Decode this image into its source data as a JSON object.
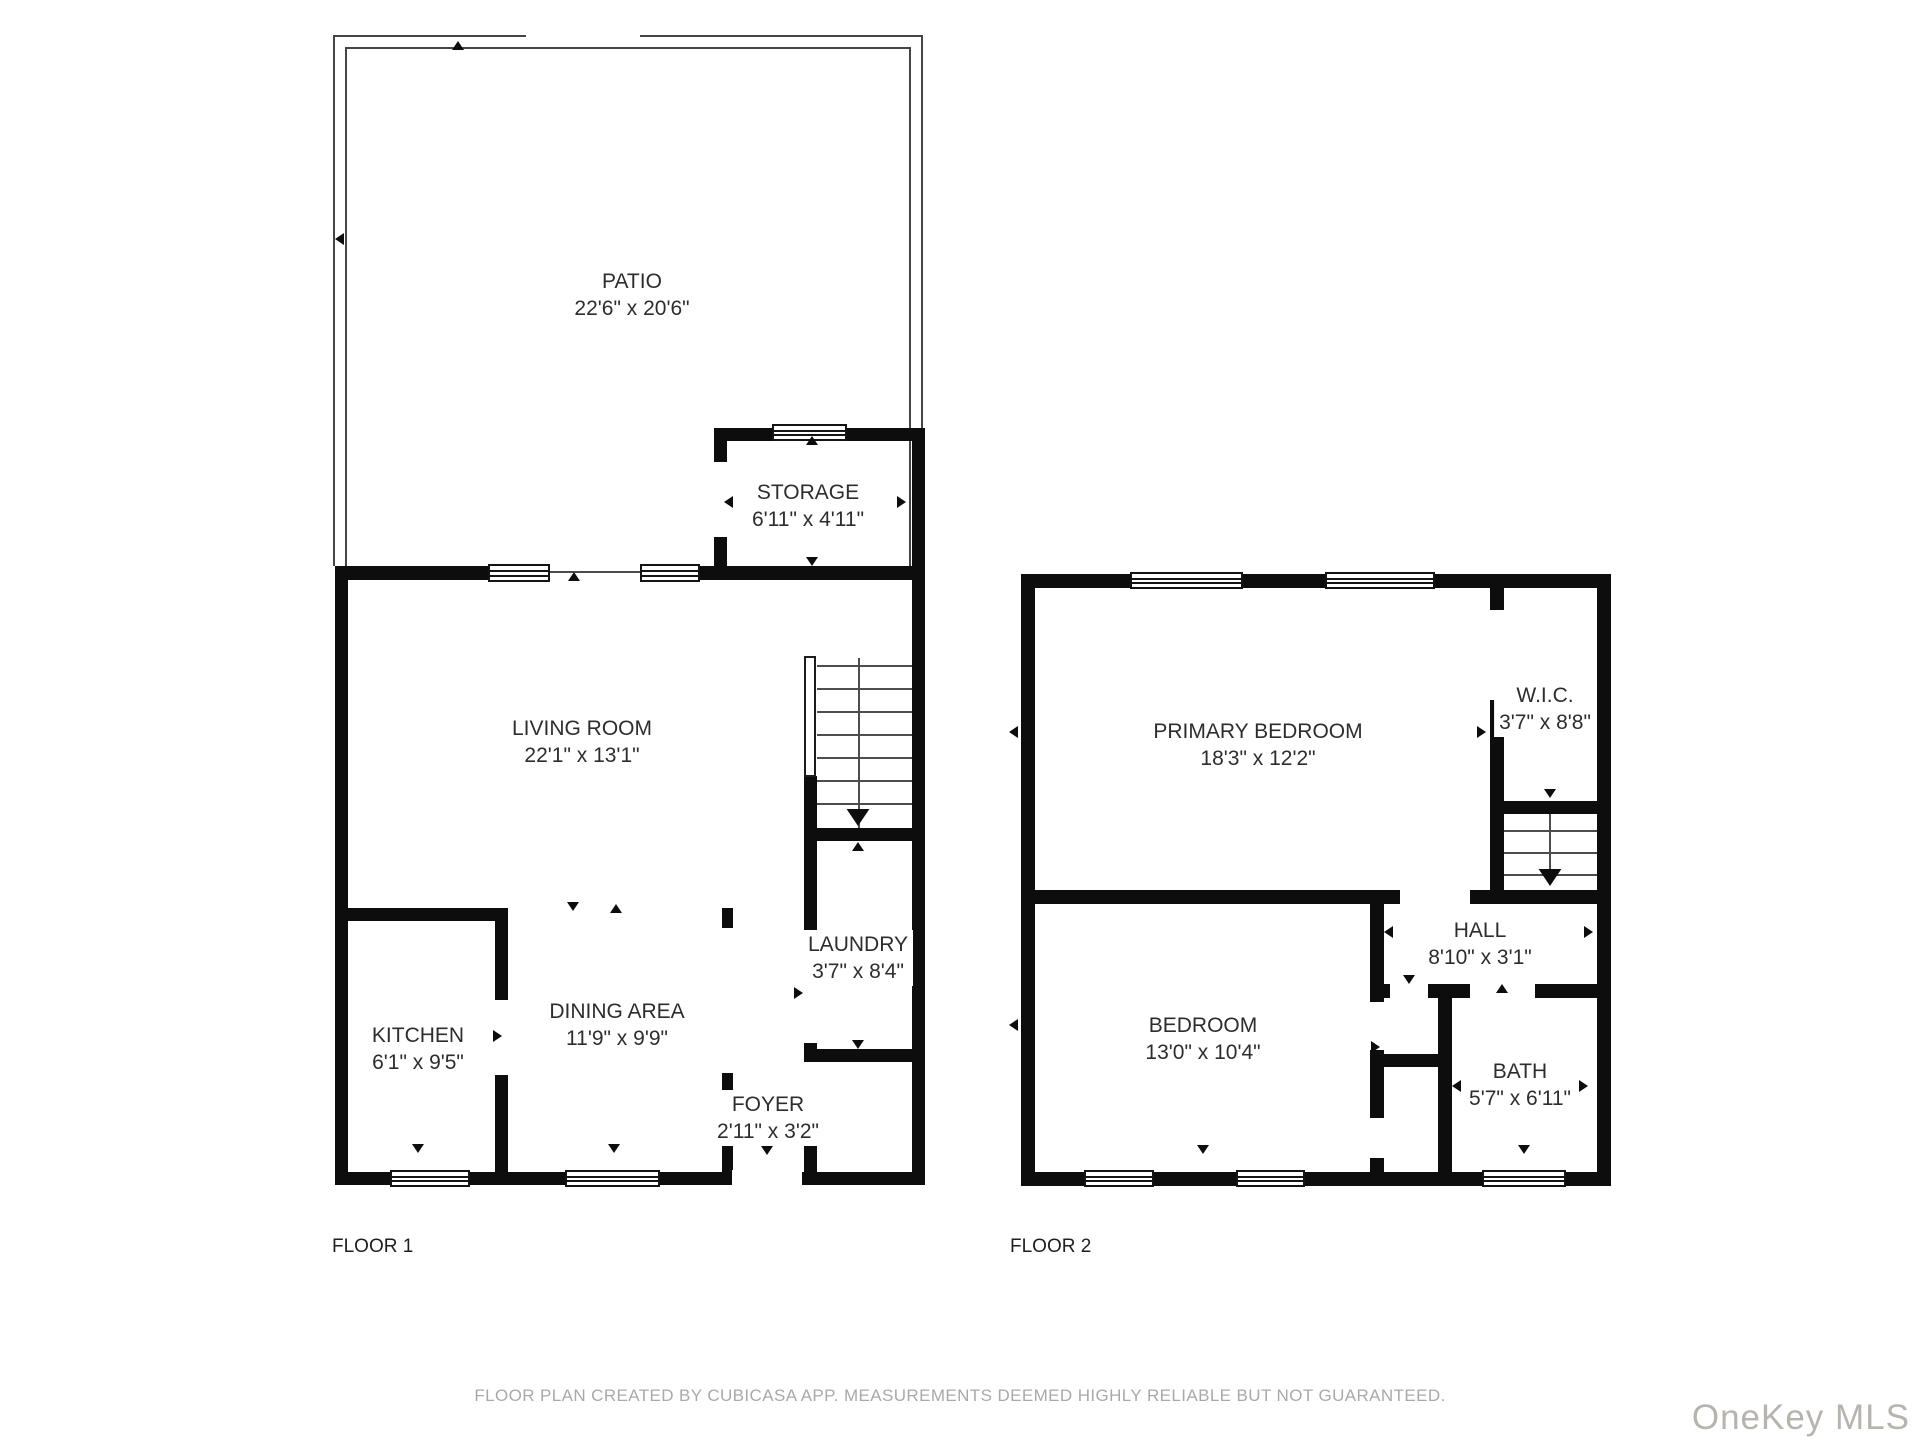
{
  "floor1": {
    "label": "FLOOR 1",
    "rooms": {
      "patio": {
        "name": "PATIO",
        "dims": "22'6\" x 20'6\""
      },
      "storage": {
        "name": "STORAGE",
        "dims": "6'11\" x 4'11\""
      },
      "living_room": {
        "name": "LIVING ROOM",
        "dims": "22'1\" x 13'1\""
      },
      "kitchen": {
        "name": "KITCHEN",
        "dims": "6'1\" x 9'5\""
      },
      "dining_area": {
        "name": "DINING AREA",
        "dims": "11'9\" x 9'9\""
      },
      "laundry": {
        "name": "LAUNDRY",
        "dims": "3'7\" x 8'4\""
      },
      "foyer": {
        "name": "FOYER",
        "dims": "2'11\" x 3'2\""
      }
    }
  },
  "floor2": {
    "label": "FLOOR 2",
    "rooms": {
      "primary_bedroom": {
        "name": "PRIMARY BEDROOM",
        "dims": "18'3\" x 12'2\""
      },
      "wic": {
        "name": "W.I.C.",
        "dims": "3'7\" x 8'8\""
      },
      "hall": {
        "name": "HALL",
        "dims": "8'10\" x 3'1\""
      },
      "bedroom": {
        "name": "BEDROOM",
        "dims": "13'0\" x 10'4\""
      },
      "bath": {
        "name": "BATH",
        "dims": "5'7\" x 6'11\""
      }
    }
  },
  "footer": {
    "disclaimer": "FLOOR PLAN CREATED BY CUBICASA APP. MEASUREMENTS DEEMED HIGHLY RELIABLE BUT NOT GUARANTEED."
  },
  "watermark": {
    "text": "OneKey MLS"
  },
  "colors": {
    "wall": "#0d0d0d",
    "thin_line": "#454545",
    "label": "#2d2d2d",
    "muted": "#a9a9a9",
    "watermark": "#b7b4ae"
  }
}
